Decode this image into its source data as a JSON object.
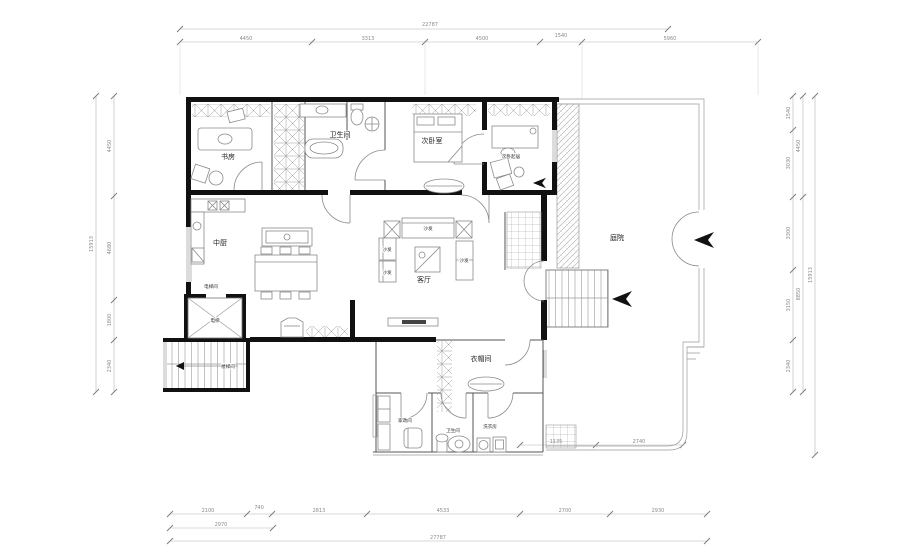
{
  "labels": {
    "study": "书房",
    "bathroom": "卫生间",
    "bedroom2": "次卧室",
    "bedroom2_lounge": "次卧起居",
    "kitchen": "中厨",
    "living": "客厅",
    "sofa": "沙发",
    "elevator_hall": "电梯间",
    "elevator": "电梯",
    "stairwell": "楼梯间",
    "cloakroom": "衣帽间",
    "utility": "家政间",
    "bathroom2": "卫生间",
    "laundry": "洗衣房",
    "courtyard": "庭院"
  },
  "dims": {
    "top_total": "22787",
    "top_segments": [
      "4450",
      "3313",
      "4500",
      "1540",
      "5960"
    ],
    "bottom_segments": [
      "2100",
      "740",
      "2813",
      "4533",
      "2700",
      "2930"
    ],
    "bottom_sub": "2970",
    "bottom_total": "27787",
    "left_segments": [
      "4450",
      "4680",
      "1800",
      "2340"
    ],
    "left_total": "15913",
    "right_segments": [
      "1540",
      "3030",
      "3300",
      "3150",
      "2340"
    ],
    "right_mid": [
      "4450",
      "8850"
    ],
    "right_total": "15913",
    "inner_bottom": [
      "1135",
      "2740"
    ]
  },
  "colors": {
    "wall": "#111111",
    "line": "#8b8b8b",
    "dim": "#8a8a8a",
    "background": "#ffffff"
  }
}
